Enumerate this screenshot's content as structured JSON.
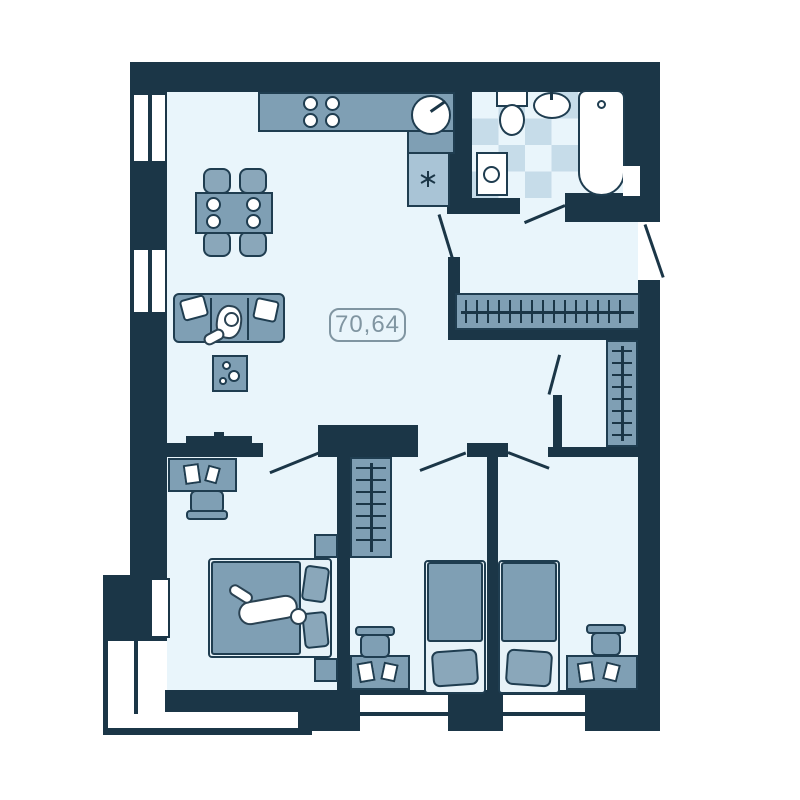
{
  "floor_plan": {
    "area_label": "70,64",
    "palette": {
      "wall": "#1b3647",
      "floor": "#e9f5fb",
      "furniture": "#7f9fb4",
      "furniture_light": "#a9c4d6",
      "bathroom_tile": "#c6dce9",
      "fixture_white": "#ffffff",
      "label_accent": "#8095a1"
    },
    "icons": {
      "fridge": "snowflake-icon",
      "stove": "four-burner-icon",
      "wardrobes": "hanger-rail-icon"
    },
    "inventory": {
      "windows": 4,
      "door_swings": 7,
      "wardrobes": 3,
      "beds": 3,
      "desks": 3
    }
  }
}
